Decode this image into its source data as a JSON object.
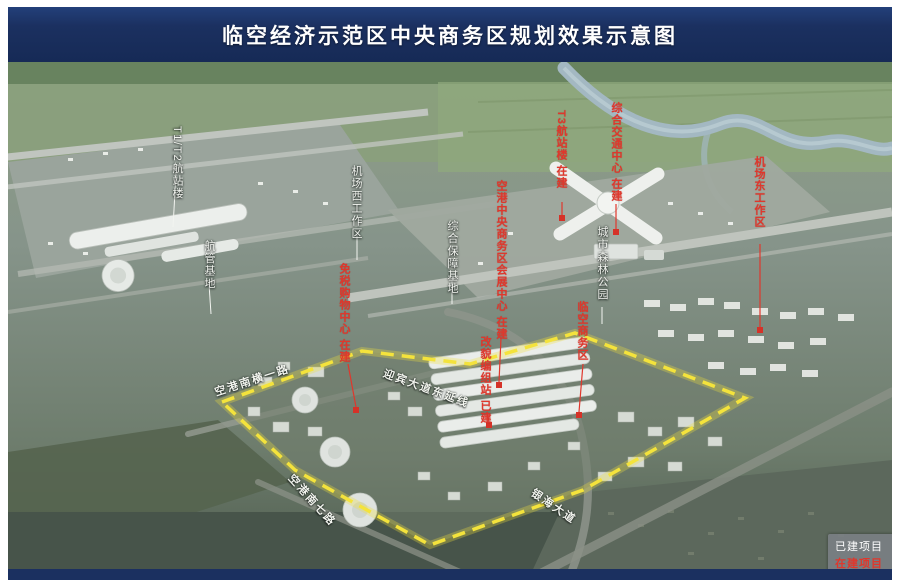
{
  "header": {
    "title": "临空经济示范区中央商务区规划效果示意图"
  },
  "legend": {
    "built_label": "已建项目",
    "under_construction_label": "在建项目"
  },
  "colors": {
    "header_navy": "#1b3060",
    "boundary_yellow": "#f2e23a",
    "red_label": "#e0372c",
    "white_label": "#f3f5f0",
    "legend_bg": "#7a7f83"
  },
  "map": {
    "labels_white": [
      {
        "id": "t1",
        "text": "T1/T2航站楼"
      },
      {
        "id": "hangguan",
        "text": "航管基地"
      },
      {
        "id": "west_work",
        "text": "机场西工作区"
      },
      {
        "id": "baozhang",
        "text": "综合保障基地"
      },
      {
        "id": "park",
        "text": "城市森林公园"
      }
    ],
    "labels_red": [
      {
        "id": "t3",
        "text": "T3航站楼 在建"
      },
      {
        "id": "gtc",
        "text": "综合交通中心 在建"
      },
      {
        "id": "east_work",
        "text": "机场东工作区"
      },
      {
        "id": "duty_free",
        "text": "免税购物中心 在建"
      },
      {
        "id": "expo",
        "text": "空港中央商务区会展中心 在建"
      },
      {
        "id": "gaimao",
        "text": "改貌编组站 已建"
      },
      {
        "id": "linkong",
        "text": "临空商务区"
      }
    ],
    "roads": [
      {
        "id": "kgnh1",
        "text": "空港南横一路"
      },
      {
        "id": "ybdd",
        "text": "迎宾大道东延线"
      },
      {
        "id": "kgn7",
        "text": "空港南七路"
      },
      {
        "id": "yhdd",
        "text": "银海大道"
      }
    ]
  }
}
